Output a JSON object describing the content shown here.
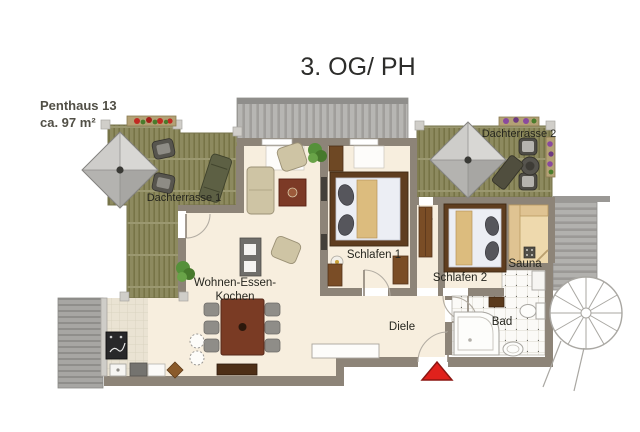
{
  "title": "3. OG/ PH",
  "unit": {
    "name": "Penthaus 13",
    "area": "ca. 97 m²"
  },
  "rooms": {
    "terrace1": "Dachterrasse 1",
    "terrace2": "Dachterrasse 2",
    "living_line1": "Wohnen-Essen-",
    "living_line2": "Kochen",
    "bedroom1": "Schlafen 1",
    "bedroom2": "Schlafen 2",
    "sauna": "Sauna",
    "hallway": "Diele",
    "bathroom": "Bad"
  },
  "colors": {
    "wall": "#8d8478",
    "floor_cream": "#f7eede",
    "deck_wood_olive": "#8d8a5f",
    "deck_gray": "#a7a6a3",
    "roof_gray": "#b7b6b3",
    "furniture_wood_dark": "#5f3d1f",
    "dining_table_wood": "#7a3b24",
    "upholstery_tan": "#cec4a4",
    "bed_blanket_tan": "#dcbc7e",
    "sauna_wood": "#eed9ad",
    "plant_green": "#55903a",
    "flowers_red": "#c12a22",
    "flowers_purple": "#8a4a9e",
    "marker_red": "#e0211c",
    "text": "#26261f"
  }
}
